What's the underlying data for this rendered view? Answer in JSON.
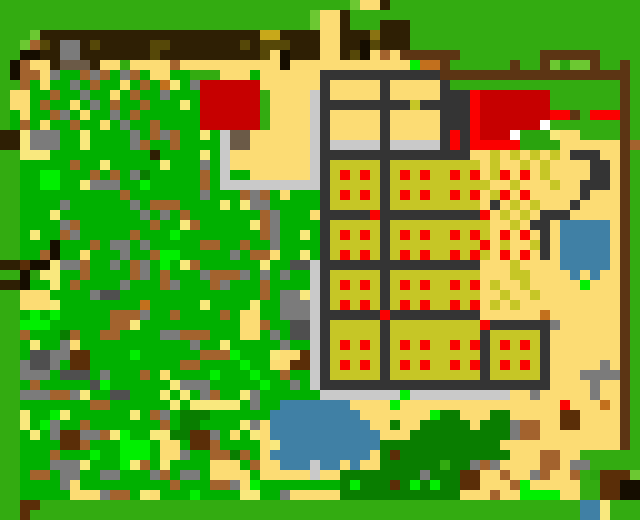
{
  "scene": {
    "title": "Top-down pixel world map",
    "description": "Procedural village map: scrub forest west, tan road and plaza, two red-roof buildings, fenced crop farm with red produce dots, ponds, dark tree groves, grass border"
  },
  "canvas": {
    "width": 640,
    "height": 520,
    "cell": 10,
    "cols": 64,
    "rows": 52
  },
  "palette": {
    ".": "#33ab11",
    ",": "#00b000",
    ";": "#2aa30e",
    "L": "#6cc832",
    "n": "#00ef00",
    "t": "#097d00",
    "Y": "#fcdc74",
    "y": "#f9e87e",
    "B": "#a3632e",
    "b": "#5a2e08",
    "r": "#c2701d",
    "D": "#2e1f04",
    "d": "#5c3514",
    "o": "#564808",
    "k": "#8a7312",
    "u": "#c8a81a",
    "U": "#c6c626",
    "g": "#7b7b7b",
    "x": "#343434",
    "A": "#4f4f4f",
    "C": "#c9c9c9",
    "K": "#150d00",
    "R": "#c60000",
    "F": "#fb0000",
    "W": "#ffffff",
    "P": "#4080a5",
    "s": "#6b5a47"
  },
  "key_colors": {
    "grass": "#33ab11",
    "scrub_green": "#00b000",
    "sand": "#fcdc74",
    "crop_field": "#c6c626",
    "crop_dot": "#fb0000",
    "building_red": "#c60000",
    "water": "#4080a5",
    "farm_border": "#343434",
    "fence_brown": "#5c3514"
  },
  "rows": [
    "...................................LYYD.............................",
    "...............................LYYD.............................",
    "...............................LYYD...DDD.......................",
    "...LDDDDDDDDDDDDDDDDDDDDDDuuDDDDYYDDDkDDD.......................",
    "..LBoDggDoDDDDDooDDDDDDDoDoooDDDYYDDKoDDD.......................",
    "..KKDDggDDDDDDDoDDDDDDDDDDoYKDDDYYDoKYBYdddddd........dddddd....",
    ".KBYYDsssDYY.YYYYBYYYYYYYYYYKYYYYYYYYYYYYnrrd......d..dL;LLd..d.",
    ".KBBYg,,BgB,gB,YY,,...YYY,YYYYYYxxxxxxxxxxxxddddddddddddddddddd.",
    "..B,Y,,g,B,,Y,B,ry,gRRRRRRYYYYYYxYYYYYxYYYYYx.................d.",
    ".YY,,B,,g,,Y,B,,g,,,RRRRRR.YYYYCxYYYYYxYYYYYxxxFRRRRRRR.......d.",
    ".YY,B,,Y,g,B,,B,,,y,RRRRRR.YYYYCxxxxxxxxxUxxxxxFRRRRRRR.......d.",
    ".,Y,,Bg,Y,,g,B,,,,,,RRRRRR.YYYYCxYYYYYxYYYYYxxxFRRRRRRRFFd.FFFd.",
    ".,B,Y,,B,,Y,g,,B,,,,RRRRRR.YYYYCxYYYYYxYYYYYxxxFRRRRRRW.......d.",
    "DDyggg,,y,,,,g,BgB,,y,CssYYYYYYCxYYYYYxYYYYYxFxFRRRW;;;yYY....d.",
    "DDyggg,,y,,,,gB,,B,,,,CssYYYYYYCxCCCCCxCCCCCxFxFFFFF;;;;YYYYYYdB",
    "..yyy,,,,,,,,,,D,,,,y,CYYYYYYYYCxxxxxxxxxxxxxxxYYUYUYUYUYxxxYYd.",
    "..,,,,,B,,y,,,,,y,,,g,CYYYYYYYYCxUUUUUxUUUUUUUUUYUYYUYUYYYYxxYd.",
    "..,,nn,,,B,B,gt,,,,,B,C,,YYYYYYCxUFUFUxUFUFUUFUFYUFYFYUYYYYxxYd.",
    "..,,nn,,yggg,,n,,,,,B,CCCCCCCCCCxUUUUUxUUUUUUUUUUYYUYYYUYYxxxYd.",
    "..,,,,,,,,,,B,,,,,,,g,,,BgB,Y,,,xUFUFUxUFUFUUFUFYUFYFYYYYYxYYYd.",
    "..,,,,g,,,,,,g,BBB,,,,y,ygg,,,,,xUUUUUxUUUUUUUUUYxYUYUYYYxYYYYd.",
    "..,,,y,,,,,,,,g,g,B,,,,,,,Bg,,,YxxxxxFxxxxxxxxxxFYUYUYxxxYYYYYd.",
    "..,,,,gB,,,,,,,B,,yB,,,,,yBg,,,,xUUUUUxUUUUUUUUUUYYUYxxYPPPPPYd.",
    "..,y,,Bg,,,,,B,,,n,,,,,,,,Bg,,y,xUFUFUxUFUFUUFUFUYFYFYxYPPPPPYd.",
    "..,,,K,,,B,gg,g,,,,,BB,,B,,g,,,,xUUUUUxUUUUUUUUUFYUYYUxYPPPPPYd.",
    "..,,BK,,Y,,,g,,Bnn,,,,,g,BBY,,y,xUFUFUxUFUFUUFUFUYFYFYxYPPPPPYd.",
    "DDbKKyggB,,g,Bg,n,yB,,,,,,y,,AACxxxxxxxxxxxxxxxxYYYUYYYYPPPPPYd.",
    "..K;yy,,B,,,,Bg,B,,,gBBBg,g,g,,CxUUUUUxUUUUUUUUUYYYUUYYYYPYPYYd.",
    "DDK,,y,B,,,,g,,,Bg,,,Bg,,,B,,,,CxUFUFUxUFUFUUFUFYUYYUYYYYYnYYYd.",
    "..YYY,,,,gAA,,,,,,,,,,,,,,B,ggyCxUUUUUxUUUUUUUUUYYUYYUYYYYYYYYd.",
    "..YYYy,,,,,,,,r,,,,,y,,,,y,,gggCxUFUFUxUFUFUUFUFYUYUYYYYYYYYYYd.",
    "..,n,n,,,,,BBBg,,B,,,,B,YY,,gggCxxxxxxFxxxxxxxxxYYYYYYrYYYYYYYd.",
    "..nnn,,,,,,BBy,,,,,,,,,,YYB,,AACxUUUUUxUUUUUUUUUFxxxxxxgYYYYYYd.",
    "..B,,,tB,,BB,,,,ggBBB,,,YY,g,AACxUUUUUxUUUUUUUUUxUUUUUxYYYYYYYd.",
    "..,y,,gY,,,,,,,,,,,g,,y,,,,,g,,CxUFUFUxUFUFUUFUFxUFUFUxYYYYYYYd.",
    "..,AAggbb,,,,n,,,,,,BBBn,,,yYYbCxUUUUUxUUUUUUUUUxUUUUUxYYYYYYYd.",
    "..gAAg,bb,,,,,,,,,BB,,,,n,,YYbbCxUFUFUxUFUFUUFUFxUFUFUxYYYYYgYd.",
    "..ggg,AAA,g,,,B,Y,,,,n,,,n,,B,,CxUUUUUxUUUUUUUUUxUUUUUxYYYggggd.",
    "..,B,,,,,An,,,,,,yggg,,,,,n,,g,CxxxxxxxxxxxxxxxxxxxxxxxYYYYgYYd.",
    "..gggBBgy,,AA,,,y,y,gB,,yg,,,,,,CCCCCCCCnCCCCCCCCCCYYgYYYYYgYYd.",
    "..,,,,,,,BB,,,,,,y,yyyyy,g,,PPPPPPPYYYYnYYYYYYYYYYYYYYYYFYYYrYd.",
    "..y,,ny,,,,,,y,Bg,ttt,,,,,,PPPPPPPPPYYYYYYYnttYYYttYYYYYbbYYYYd.",
    "..y,ng,,B,,,,,,,B,tt,,,,ygYPPPPPPPPPPYYtYYtttttYtttgBBYYbbYYYYd.",
    "..,y,gbbggByn,,yyttbbg,Y,yYPPPPPPPPPPPYYYttttttttttgBBYYYYYYYYd.",
    "..,,,,bbB,,,nnn,YY,bbB,,,,YyPPPPPPPPPPttttttttttttYYYYYYYYYYYYd.",
    "..,,,B,,,n,,nnn,YYg,,BBtB,YPPPPPPPPPPYtbtttttttttttYYYBBYY......",
    "..,,,gggy,,,nyB,y,,,,YYY,BYYPPPCPPYPYYtttttt ttgBgYYYYBBYgg......",
    "..,BB,gg,,gg,,,gB,gg,YYYY,YYYYYCYYttttttttgtttbbYYBYYgBYYB.;bbbL",
    "..,,,,gY,,,,,,,,,B,,,BBgYn,,,,,,,,tntttbtntnttbbYYYBnYYYYY..bbKK",
    "..,,,,,YYYgBB,yY,,,n,,,,yy,,gYYYYYttttttttttttYYYBYYnnnnYY..bbKK",
    "..bb......................................................PPy.",
    "..b.......................................................PPy."
  ],
  "landmarks": [
    {
      "id": "gray-shed",
      "x": 55,
      "y": 38,
      "w": 28,
      "h": 28
    },
    {
      "id": "north-road",
      "x": 320,
      "y": 0,
      "w": 26,
      "h": 66
    },
    {
      "id": "red-house-west",
      "x": 200,
      "y": 80,
      "w": 60,
      "h": 50
    },
    {
      "id": "red-house-east",
      "x": 462,
      "y": 88,
      "w": 84,
      "h": 46
    },
    {
      "id": "plaza-courtyard",
      "x": 220,
      "y": 130,
      "w": 100,
      "h": 62
    },
    {
      "id": "farm-grid",
      "x": 320,
      "y": 66,
      "w": 225,
      "h": 322
    },
    {
      "id": "leafy-field",
      "x": 480,
      "y": 152,
      "w": 70,
      "h": 236
    },
    {
      "id": "animal-pen",
      "x": 540,
      "y": 52,
      "w": 62,
      "h": 30
    },
    {
      "id": "scrub-forest",
      "x": 20,
      "y": 60,
      "w": 295,
      "h": 436
    },
    {
      "id": "east-pond",
      "x": 555,
      "y": 218,
      "w": 55,
      "h": 50
    },
    {
      "id": "main-pond",
      "x": 260,
      "y": 395,
      "w": 120,
      "h": 74
    },
    {
      "id": "south-tree-grove",
      "x": 330,
      "y": 400,
      "w": 190,
      "h": 98
    },
    {
      "id": "small-pond-south",
      "x": 598,
      "y": 500,
      "w": 26,
      "h": 20
    },
    {
      "id": "east-fence-line",
      "x": 620,
      "y": 62,
      "w": 12,
      "h": 384
    }
  ]
}
